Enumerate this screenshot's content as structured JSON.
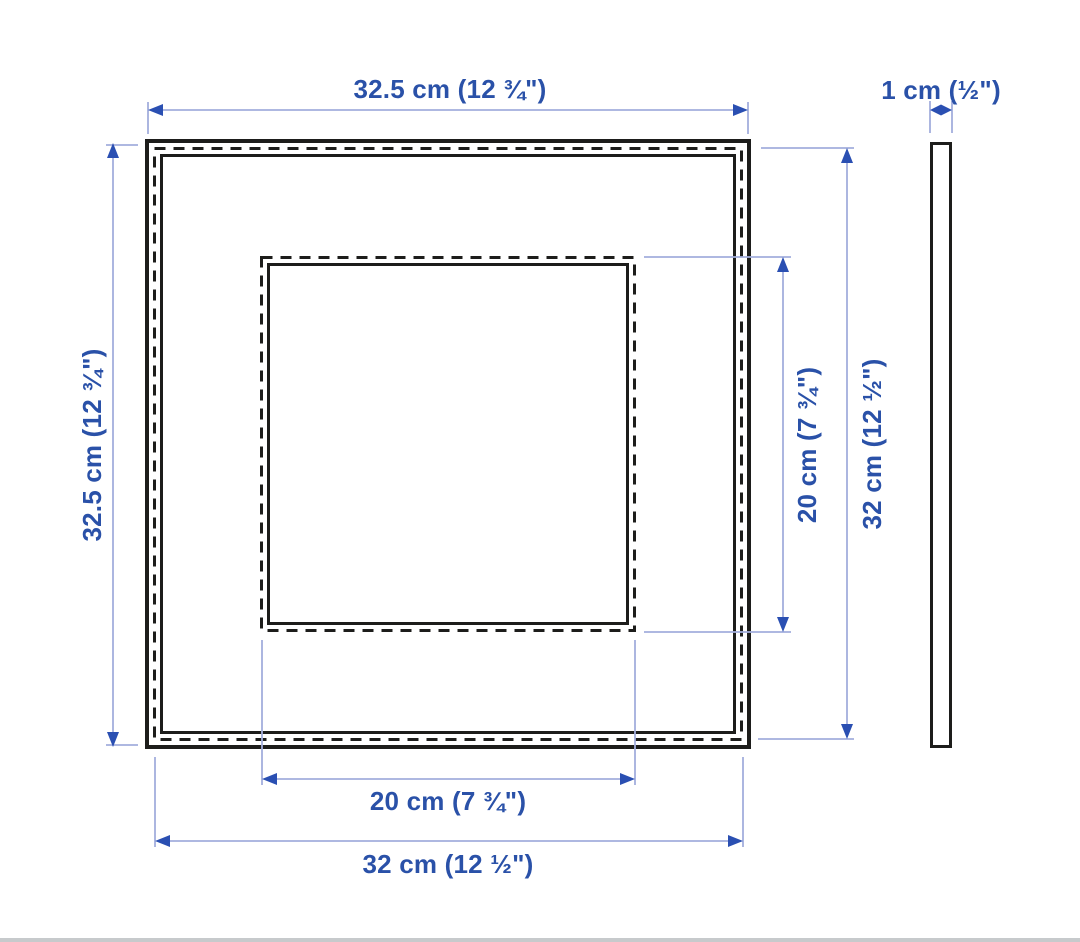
{
  "diagram": {
    "product": "square picture frame dimension drawing",
    "views": {
      "front": "frame front view with mat opening",
      "side": "frame side profile"
    },
    "colors": {
      "outline": "#1d1d1b",
      "dimension_line": "#a3aedd",
      "dimension_arrow": "#2a4fb2",
      "dimension_text": "#2a51a8",
      "background": "#ffffff",
      "footer_divider": "#c7cacc"
    },
    "labels": {
      "front_width_top": "32.5 cm (12 ¾\")",
      "front_height_left": "32.5 cm (12 ¾\")",
      "opening_height_right": "20 cm (7 ¾\")",
      "picture_height_right": "32 cm (12 ½\")",
      "opening_width_bottom": "20 cm (7 ¾\")",
      "picture_width_bottom": "32 cm (12 ½\")",
      "side_thickness": "1 cm (½\")"
    },
    "measurements": {
      "outer_width_cm": 32.5,
      "outer_height_cm": 32.5,
      "picture_width_cm": 32,
      "picture_height_cm": 32,
      "opening_width_cm": 20,
      "opening_height_cm": 20,
      "thickness_cm": 1
    }
  }
}
